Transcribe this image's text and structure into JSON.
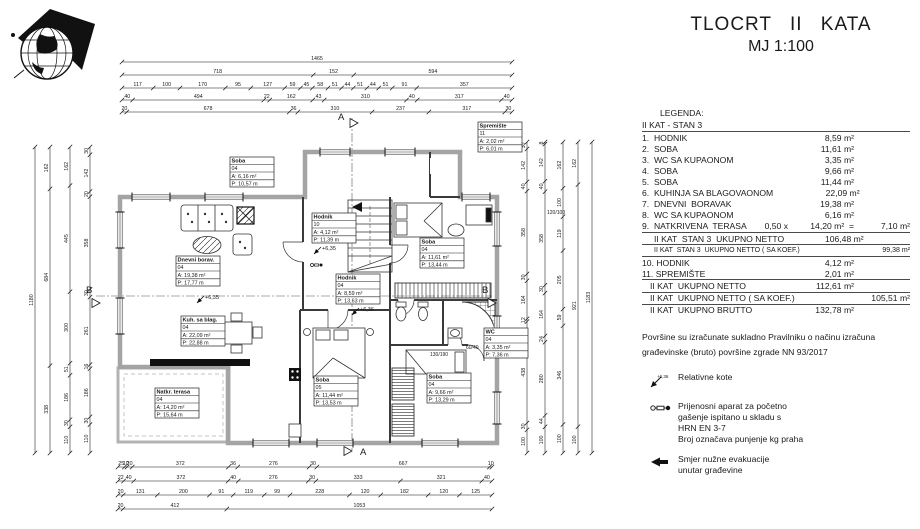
{
  "title": {
    "line1": "TLOCRT II KATA",
    "line2": "MJ 1:100"
  },
  "legend": {
    "heading": "LEGENDA:",
    "subheading": "II KAT - STAN 3",
    "rows": [
      {
        "l": "1.  HODNIK",
        "v": "8,59 m²"
      },
      {
        "l": "2.  SOBA",
        "v": "11,61 m²"
      },
      {
        "l": "3.  WC SA KUPAONOM",
        "v": "3,35 m²"
      },
      {
        "l": "4.  SOBA",
        "v": "9,66 m²"
      },
      {
        "l": "5.  SOBA",
        "v": "11,44 m²"
      },
      {
        "l": "6.  KUHINJA SA BLAGOVAONOM",
        "v": "22,09 m²"
      },
      {
        "l": "7.  DNEVNI  BORAVAK",
        "v": "19,38 m²"
      },
      {
        "l": "8.  WC SA KUPAONOM",
        "v": "6,16 m²"
      },
      {
        "l": "9.  NATKRIVENA  TERASA",
        "m": "0,50 x",
        "v": "14,20 m²  =",
        "e": "7,10 m²",
        "c": "bb"
      },
      {
        "l": "II KAT  STAN 3  UKUPNO NETTO",
        "v": "106,48 m²",
        "c": "ind bb"
      },
      {
        "l": "II KAT  STAN 3  UKUPNO NETTO ( SA KOEF.)",
        "e": "99,38 m²",
        "c": "ind sm bb"
      },
      {
        "l": "10. HODNIK",
        "v": "4,12 m²"
      },
      {
        "l": "11. SPREMIŠTE",
        "v": "2,01 m²",
        "c": "bb"
      },
      {
        "l": "II KAT  UKUPNO NETTO",
        "v": "112,61 m²",
        "c": "ind2 bb"
      },
      {
        "l": "II KAT  UKUPNO NETTO ( SA KOEF.)",
        "e": "105,51 m²",
        "c": "ind2 bb"
      },
      {
        "l": "II KAT  UKUPNO BRUTTO",
        "v": "132,78 m²",
        "c": "ind2"
      }
    ]
  },
  "note": {
    "line1": "Površine su izračunate sukladno  Pravilniku o načinu izračuna",
    "line2": "građevinske (bruto) površine zgrade NN 93/2017"
  },
  "symbols": [
    {
      "icon": "elevation-marker-icon",
      "tiny": "+6,36",
      "lines": [
        "Relativne  kote"
      ]
    },
    {
      "icon": "fire-extinguisher-icon",
      "tiny": "",
      "lines": [
        "Prijenosni aparat za početno",
        "gašenje ispitano u skladu s",
        "HRN EN 3-7",
        "Broj označava punjenje kg praha"
      ]
    },
    {
      "icon": "evacuation-arrow-icon",
      "tiny": "",
      "lines": [
        "Smjer  nužne evakuacije",
        "unutar građevine"
      ]
    }
  ],
  "plan": {
    "rooms": [
      {
        "name": "Spremište",
        "id": "11",
        "a": "A:   2,02 m²",
        "p": "P:   6,01 m",
        "x": 478,
        "y": 122
      },
      {
        "name": "Soba",
        "id": "04",
        "a": "A:   6,16 m²",
        "p": "P:  10,57 m",
        "x": 230,
        "y": 157
      },
      {
        "name": "Hodnik",
        "id": "10",
        "a": "A:   4,12 m²",
        "p": "P:  11,39 m",
        "x": 312,
        "y": 213
      },
      {
        "name": "Soba",
        "id": "04",
        "a": "A:  11,61 m²",
        "p": "P:  13,44 m",
        "x": 420,
        "y": 238
      },
      {
        "name": "Dnevni borav.",
        "id": "04",
        "a": "A:  19,38 m²",
        "p": "P:  17,77 m",
        "x": 176,
        "y": 256
      },
      {
        "name": "Hodnik",
        "id": "04",
        "a": "A:   8,59 m²",
        "p": "P:  13,63 m",
        "x": 336,
        "y": 274
      },
      {
        "name": "Kuh. sa blag.",
        "id": "04",
        "a": "A:  22,09 m²",
        "p": "P:  22,88 m",
        "x": 181,
        "y": 316
      },
      {
        "name": "Natkr. terasa",
        "id": "04",
        "a": "A:  14,20 m²",
        "p": "P:  15,64 m",
        "x": 155,
        "y": 388
      },
      {
        "name": "Soba",
        "id": "05",
        "a": "A:  11,44 m²",
        "p": "P:  13,53 m",
        "x": 314,
        "y": 376
      },
      {
        "name": "Soba",
        "id": "04",
        "a": "A:   9,66 m²",
        "p": "P:  13,29 m",
        "x": 427,
        "y": 373
      },
      {
        "name": "WC",
        "id": "04",
        "a": "A:   3,35 m²",
        "p": "P:   7,36 m",
        "x": 484,
        "y": 328
      }
    ],
    "elevations": [
      {
        "text": "+6,35",
        "x": 322,
        "y": 250
      },
      {
        "text": "+6,35",
        "x": 205,
        "y": 299
      },
      {
        "text": "+6,36",
        "x": 360,
        "y": 311
      }
    ],
    "window_labels": [
      {
        "text": "120/100",
        "x": 547,
        "y": 214
      },
      {
        "text": "60/40",
        "x": 466,
        "y": 349
      },
      {
        "text": "130/190",
        "x": 430,
        "y": 356
      }
    ],
    "section_markers": [
      {
        "letter": "A",
        "x": 338,
        "y": 120,
        "tx": 350,
        "ty": 123
      },
      {
        "letter": "A",
        "x": 360,
        "y": 455,
        "tx": 344,
        "ty": 451
      },
      {
        "letter": "B",
        "x": 86,
        "y": 293,
        "tx": 92,
        "ty": 303
      },
      {
        "letter": "B",
        "x": 482,
        "y": 293,
        "tx": 488,
        "ty": 303
      }
    ],
    "h_chains": [
      {
        "y": 62,
        "x1": 122,
        "x2": 512,
        "values": [
          "1465"
        ]
      },
      {
        "y": 75,
        "x1": 122,
        "x2": 512,
        "values": [
          "718",
          "152",
          "594"
        ]
      },
      {
        "y": 88,
        "x1": 122,
        "x2": 512,
        "values": [
          "117",
          "100",
          "170",
          "95",
          "127",
          "59",
          "45",
          "58",
          "51",
          "44",
          "51",
          "44",
          "51",
          "91",
          "357"
        ]
      },
      {
        "y": 100,
        "x1": 122,
        "x2": 512,
        "values": [
          "40",
          "494",
          "22",
          "162",
          "43",
          "310",
          "40",
          "317",
          "40"
        ]
      },
      {
        "y": 112,
        "x1": 122,
        "x2": 512,
        "values": [
          "20",
          "678",
          "36",
          "310",
          "237",
          "317",
          "30"
        ]
      },
      {
        "y": 467,
        "x1": 118,
        "x2": 492,
        "values": [
          "25",
          "10",
          "20",
          "372",
          "36",
          "276",
          "30",
          "667",
          "10"
        ]
      },
      {
        "y": 481,
        "x1": 118,
        "x2": 492,
        "values": [
          "22",
          "40",
          "372",
          "40",
          "276",
          "30",
          "333",
          "321",
          "40"
        ]
      },
      {
        "y": 495,
        "x1": 118,
        "x2": 492,
        "values": [
          "20",
          "131",
          "200",
          "91",
          "119",
          "99",
          "228",
          "120",
          "182",
          "120",
          "125"
        ]
      },
      {
        "y": 509,
        "x1": 118,
        "x2": 492,
        "values": [
          "20",
          "412",
          "1053"
        ]
      }
    ],
    "v_chains": [
      {
        "x": 35,
        "y1": 147,
        "y2": 453,
        "values": [
          "1180"
        ]
      },
      {
        "x": 50,
        "y1": 147,
        "y2": 453,
        "values": [
          "162",
          "684",
          "338"
        ]
      },
      {
        "x": 70,
        "y1": 147,
        "y2": 453,
        "values": [
          "162",
          "445",
          "300",
          "51",
          "186",
          "30",
          "110"
        ]
      },
      {
        "x": 90,
        "y1": 147,
        "y2": 453,
        "values": [
          "30",
          "142",
          "20",
          "358",
          "30",
          "261",
          "16",
          "186",
          "30",
          "110"
        ]
      },
      {
        "x": 527,
        "y1": 142,
        "y2": 453,
        "values": [
          "30",
          "142",
          "40",
          "358",
          "30",
          "164",
          "12",
          "438",
          "30",
          "100"
        ]
      },
      {
        "x": 545,
        "y1": 142,
        "y2": 453,
        "values": [
          "8",
          "142",
          "40",
          "358",
          "30",
          "164",
          "24",
          "280",
          "44",
          "100"
        ]
      },
      {
        "x": 563,
        "y1": 142,
        "y2": 453,
        "values": [
          "162",
          "100",
          "119",
          "205",
          "59",
          "346",
          "100"
        ]
      },
      {
        "x": 578,
        "y1": 142,
        "y2": 453,
        "values": [
          "162",
          "921",
          "100"
        ]
      },
      {
        "x": 592,
        "y1": 142,
        "y2": 453,
        "values": [
          "1183"
        ]
      }
    ]
  }
}
